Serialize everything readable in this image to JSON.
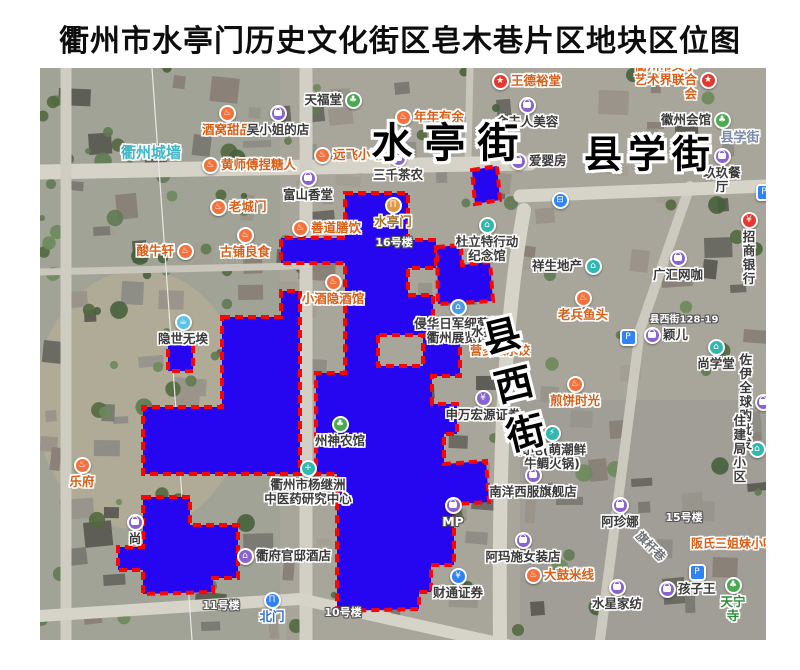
{
  "title": "衢州市水亭门历史文化街区皂木巷片区地块区位图",
  "map": {
    "street_labels": [
      {
        "text": "水亭街",
        "x": 451,
        "y": 139,
        "size": 41,
        "spacing": 12,
        "vertical": false,
        "rotate": 0
      },
      {
        "text": "县学街",
        "x": 650,
        "y": 151,
        "size": 38,
        "spacing": 6,
        "vertical": false,
        "rotate": 0
      },
      {
        "text": "县西街",
        "x": 512,
        "y": 390,
        "size": 38,
        "spacing": 12,
        "vertical": true,
        "rotate": -14
      }
    ],
    "minor_labels": [
      {
        "text": "衢州城墙",
        "x": 151,
        "y": 152,
        "color": "#3fb6c9",
        "size": 15,
        "rotate": 0,
        "shadow": "white"
      },
      {
        "text": "县学街",
        "x": 740,
        "y": 136,
        "color": "#7a8aa8",
        "size": 13,
        "rotate": 0,
        "shadow": "white"
      },
      {
        "text": "旗杆巷",
        "x": 651,
        "y": 546,
        "color": "#6f7377",
        "size": 12,
        "rotate": 45,
        "shadow": "white"
      },
      {
        "text": "县西街128-19",
        "x": 684,
        "y": 318,
        "color": "#ffffff",
        "size": 10,
        "rotate": 0,
        "shadow": "dark"
      },
      {
        "text": "15号楼",
        "x": 684,
        "y": 517,
        "color": "#ffffff",
        "size": 11,
        "rotate": 0,
        "shadow": "dark"
      },
      {
        "text": "16号楼",
        "x": 394,
        "y": 242,
        "color": "#ffffff",
        "size": 11,
        "rotate": 0,
        "shadow": "dark"
      },
      {
        "text": "11号楼",
        "x": 221,
        "y": 605,
        "color": "#ffffff",
        "size": 11,
        "rotate": 0,
        "shadow": "dark"
      },
      {
        "text": "10号楼",
        "x": 343,
        "y": 612,
        "color": "#ffffff",
        "size": 11,
        "rotate": 0,
        "shadow": "dark"
      },
      {
        "text": "阪氏三姐妹小吃",
        "x": 733,
        "y": 543,
        "color": "#d95f18",
        "size": 12,
        "rotate": 0,
        "shadow": "white"
      },
      {
        "text": "营多滋水饺",
        "x": 500,
        "y": 350,
        "color": "#d95f18",
        "size": 12,
        "rotate": 0,
        "shadow": "white"
      }
    ],
    "cats": {
      "food": {
        "bg": "#f5713c",
        "glyph": "♨",
        "text": "#d95f18",
        "shape": "circle"
      },
      "shop": {
        "bg": "#8a63d2",
        "glyph": "bag",
        "text": "#3a3a3a",
        "shape": "circle"
      },
      "green": {
        "bg": "#48ab4f",
        "glyph": "♣",
        "text": "#3a3a3a",
        "shape": "circle"
      },
      "teal": {
        "bg": "#2fb8b0",
        "glyph": "⌂",
        "text": "#3a3a3a",
        "shape": "circle"
      },
      "museum": {
        "bg": "#4a9ae8",
        "glyph": "⌂",
        "text": "#3a3a3a",
        "shape": "circle"
      },
      "lightblue": {
        "bg": "#59c3e8",
        "glyph": "☕",
        "text": "#3a3a3a",
        "shape": "circle"
      },
      "bank": {
        "bg": "#e6382e",
        "glyph": "¥",
        "text": "#3a3a3a",
        "shape": "circle"
      },
      "star": {
        "bg": "#e6382e",
        "glyph": "★",
        "text": "#d95f18",
        "shape": "circle"
      },
      "secur": {
        "bg": "#8a63d2",
        "glyph": "¥",
        "text": "#3a3a3a",
        "shape": "circle"
      },
      "finblue": {
        "bg": "#2f83f7",
        "glyph": "¥",
        "text": "#3a3a3a",
        "shape": "circle"
      },
      "park": {
        "bg": "#2f83f7",
        "glyph": "P",
        "text": "#3a3a3a",
        "shape": "square"
      },
      "bus": {
        "bg": "#2f83f7",
        "glyph": "⊟",
        "text": "#3a3a3a",
        "shape": "circle"
      },
      "scenic": {
        "bg": "#de9b43",
        "glyph": "Π",
        "text": "#a2742e",
        "shape": "circle"
      },
      "hotel": {
        "bg": "#8a63d2",
        "glyph": "⌂",
        "text": "#3a3a3a",
        "shape": "circle"
      },
      "charge": {
        "bg": "#2fb8b0",
        "glyph": "⚡",
        "text": "#3a3a3a",
        "shape": "circle"
      },
      "med": {
        "bg": "#2fb8b0",
        "glyph": "+",
        "text": "#3a3a3a",
        "shape": "circle"
      },
      "bluegate": {
        "bg": "#2f83f7",
        "glyph": "Π",
        "text": "#2f6fd0",
        "shape": "circle"
      }
    },
    "pois": [
      {
        "label": "酒窝甜品",
        "x": 227,
        "y": 113,
        "cat": "food",
        "pos": "below"
      },
      {
        "label": "吴小姐的店",
        "x": 278,
        "y": 113,
        "cat": "shop",
        "pos": "below"
      },
      {
        "label": "天福堂",
        "x": 353,
        "y": 100,
        "cat": "green",
        "pos": "left"
      },
      {
        "label": "年年有余",
        "x": 403,
        "y": 117,
        "cat": "food",
        "pos": "right"
      },
      {
        "label": "王德裕堂",
        "x": 500,
        "y": 81,
        "cat": "star",
        "pos": "right"
      },
      {
        "label": "衢州市文学\n艺术界联合会",
        "x": 708,
        "y": 80,
        "cat": "star",
        "pos": "left"
      },
      {
        "label": "徽州会馆",
        "x": 722,
        "y": 120,
        "cat": "green",
        "pos": "left"
      },
      {
        "label": "金夫人美容",
        "x": 527,
        "y": 105,
        "cat": "shop",
        "pos": "below"
      },
      {
        "label": "远飞小吃",
        "x": 322,
        "y": 155,
        "cat": "food",
        "pos": "right"
      },
      {
        "label": "三千茶农",
        "x": 398,
        "y": 158,
        "cat": "shop",
        "pos": "below"
      },
      {
        "label": "爱婴房",
        "x": 518,
        "y": 161,
        "cat": "shop",
        "pos": "right"
      },
      {
        "label": "富山香堂",
        "x": 308,
        "y": 178,
        "cat": "shop",
        "pos": "below"
      },
      {
        "label": "黄师傅捏糖人",
        "x": 210,
        "y": 165,
        "cat": "food",
        "pos": "right"
      },
      {
        "label": "老城门",
        "x": 218,
        "y": 207,
        "cat": "food",
        "pos": "right"
      },
      {
        "label": "善道膳饮",
        "x": 300,
        "y": 228,
        "cat": "food",
        "pos": "right"
      },
      {
        "label": "古铺良食",
        "x": 245,
        "y": 235,
        "cat": "food",
        "pos": "below"
      },
      {
        "label": "酸牛轩",
        "x": 185,
        "y": 251,
        "cat": "food",
        "pos": "left"
      },
      {
        "label": "水亭门",
        "x": 393,
        "y": 205,
        "cat": "scenic",
        "pos": "below"
      },
      {
        "label": "小酒隐酒馆",
        "x": 333,
        "y": 282,
        "cat": "food",
        "pos": "below"
      },
      {
        "label": "杜立特行动\n纪念馆",
        "x": 487,
        "y": 225,
        "cat": "teal",
        "pos": "below"
      },
      {
        "label": "玖玖餐厅",
        "x": 722,
        "y": 156,
        "cat": "shop",
        "pos": "below"
      },
      {
        "label": "招商银行",
        "x": 749,
        "y": 220,
        "cat": "bank",
        "pos": "below"
      },
      {
        "label": "祥生地产",
        "x": 593,
        "y": 266,
        "cat": "teal",
        "pos": "left"
      },
      {
        "label": "老兵鱼头",
        "x": 583,
        "y": 298,
        "cat": "food",
        "pos": "below"
      },
      {
        "label": "广汇网咖",
        "x": 678,
        "y": 258,
        "cat": "shop",
        "pos": "below"
      },
      {
        "label": "颖儿",
        "x": 652,
        "y": 335,
        "cat": "shop",
        "pos": "right"
      },
      {
        "label": "尚学堂",
        "x": 716,
        "y": 347,
        "cat": "teal",
        "pos": "below"
      },
      {
        "label": "隐世无埃",
        "x": 183,
        "y": 322,
        "cat": "lightblue",
        "pos": "below"
      },
      {
        "label": "侵华日军细菌战\n衢州展览馆",
        "x": 458,
        "y": 307,
        "cat": "museum",
        "pos": "below"
      },
      {
        "label": "水扬",
        "x": 507,
        "y": 332,
        "cat": "shop",
        "pos": "left"
      },
      {
        "label": "煎饼时光",
        "x": 575,
        "y": 384,
        "cat": "food",
        "pos": "below"
      },
      {
        "label": "申万宏源证券",
        "x": 483,
        "y": 398,
        "cat": "secur",
        "pos": "below"
      },
      {
        "label": "佐伊全球购批发",
        "x": 763,
        "y": 402,
        "cat": "shop",
        "pos": "left"
      },
      {
        "label": "街电(萌潮鲜\n牛鲷火锅)",
        "x": 552,
        "y": 433,
        "cat": "charge",
        "pos": "below"
      },
      {
        "label": "住建局小区",
        "x": 757,
        "y": 449,
        "cat": "teal",
        "pos": "left"
      },
      {
        "label": "州神农馆",
        "x": 340,
        "y": 424,
        "cat": "green",
        "pos": "below"
      },
      {
        "label": "衢州市杨继洲\n中医药研究中心",
        "x": 308,
        "y": 468,
        "cat": "med",
        "pos": "below"
      },
      {
        "label": "南洋西服旗舰店",
        "x": 533,
        "y": 475,
        "cat": "shop",
        "pos": "below"
      },
      {
        "label": "MP",
        "x": 453,
        "y": 505,
        "cat": "shop",
        "pos": "below",
        "tcolor": "#ffffff"
      },
      {
        "label": "阿珍娜",
        "x": 620,
        "y": 505,
        "cat": "shop",
        "pos": "below"
      },
      {
        "label": "阿玛施女装店",
        "x": 523,
        "y": 540,
        "cat": "shop",
        "pos": "below"
      },
      {
        "label": "衢府官邸酒店",
        "x": 245,
        "y": 556,
        "cat": "hotel",
        "pos": "right"
      },
      {
        "label": "尚",
        "x": 135,
        "y": 522,
        "cat": "shop",
        "pos": "below"
      },
      {
        "label": "乐府",
        "x": 82,
        "y": 465,
        "cat": "food",
        "pos": "below"
      },
      {
        "label": "大鼓米线",
        "x": 533,
        "y": 575,
        "cat": "food",
        "pos": "right"
      },
      {
        "label": "水星家纺",
        "x": 617,
        "y": 587,
        "cat": "shop",
        "pos": "below"
      },
      {
        "label": "孩子王",
        "x": 667,
        "y": 589,
        "cat": "shop",
        "pos": "right"
      },
      {
        "label": "天宁寺",
        "x": 733,
        "y": 585,
        "cat": "green",
        "pos": "below",
        "tcolor": "#2c8c3c"
      },
      {
        "label": "财通证券",
        "x": 458,
        "y": 576,
        "cat": "finblue",
        "pos": "below"
      },
      {
        "label": "北门",
        "x": 272,
        "y": 600,
        "cat": "bluegate",
        "pos": "below"
      }
    ],
    "markers": [
      {
        "cat": "park",
        "x": 628,
        "y": 337
      },
      {
        "cat": "park",
        "x": 697,
        "y": 572
      },
      {
        "cat": "park",
        "x": 764,
        "y": 192
      },
      {
        "cat": "bus",
        "x": 560,
        "y": 200
      }
    ],
    "parcels": {
      "fill": "#2606f0",
      "stroke": "#fa0505",
      "paths": [
        "M345,193 L408,193 L408,240 L436,240 L436,268 L408,268 L408,295 L433,295 L433,338 L460,338 L460,376 L432,376 L432,404 L457,404 L457,434 L444,434 L444,464 L486,461 L489,502 L454,504 L454,565 L431,565 L431,592 L419,592 L419,609 L337,611 L337,474 L316,474 L316,373 L345,373 L345,263 L281,263 L281,238 L345,238 Z M378,335 L378,366 L423,366 L423,335 Z",
        "M437,247 L461,245 L462,265 L490,262 L493,301 L438,304 Z",
        "M472,170 L497,166 L500,200 L475,204 Z",
        "M222,317 L281,317 L281,291 L300,291 L300,474 L143,474 L143,407 L222,407 Z",
        "M168,344 L193,344 L193,371 L168,371 Z",
        "M143,497 L190,497 L190,525 L238,525 L238,578 L213,578 L213,592 L143,594 L143,570 L118,570 L118,547 L143,547 Z"
      ]
    }
  }
}
